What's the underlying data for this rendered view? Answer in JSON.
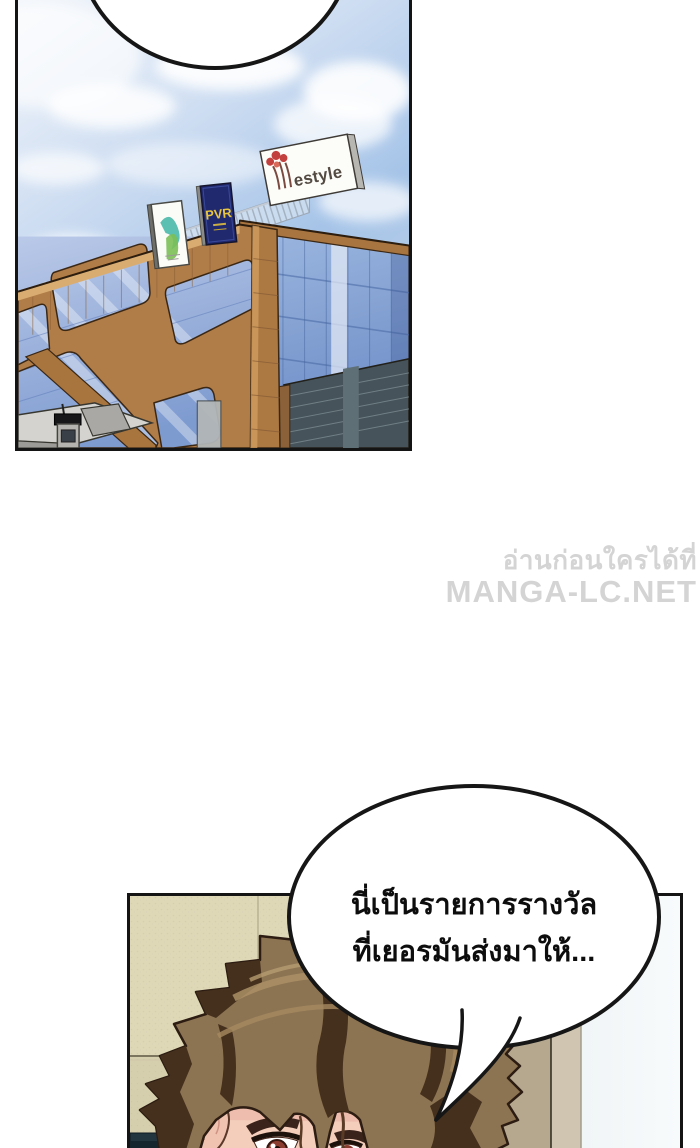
{
  "page": {
    "background": "#ffffff"
  },
  "watermark": {
    "line1": "อ่านก่อนใครได้ที่",
    "line2": "MANGA-LC.NET",
    "color": "#d4d4d4"
  },
  "bubbles": {
    "top": {
      "text": ""
    },
    "reward": {
      "line1": "นี่เป็นรายการรางวัล",
      "line2": "ที่เยอรมันส่งมาให้..."
    }
  },
  "panels": {
    "building": {
      "signs": {
        "pvr_label": "PVR",
        "lifestyle_label": "estyle"
      },
      "colors": {
        "sky_blue": "#a6c4e8",
        "frame_brown": "#b07c47",
        "glass_blue": "#7e9bd0",
        "dark_glass": "#46535a",
        "pvr_board": "#20286e",
        "pvr_text": "#e9c63d",
        "lifestyle_tree_red": "#c2403e"
      }
    },
    "character": {
      "colors": {
        "wall_beige": "#ded8b7",
        "hair_brown": "#8c7352",
        "hair_shadow": "#45301d",
        "skin": "#f4cdbb",
        "door_dark": "#4c4434",
        "door_tan": "#b5a88f",
        "iris_red": "#8c3c2e"
      }
    }
  }
}
